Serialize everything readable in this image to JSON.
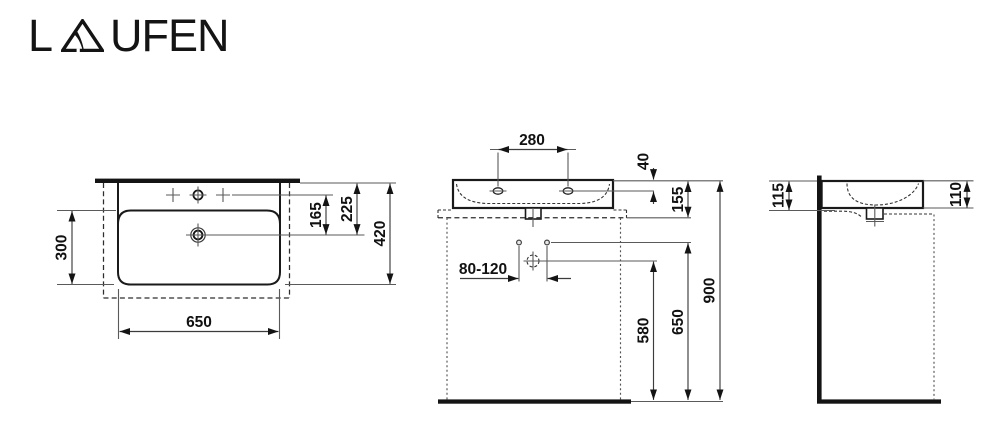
{
  "brand": {
    "name": "LAUFEN",
    "logo_l": "L",
    "logo_rest": "UFEN"
  },
  "drawing": {
    "views": {
      "plan": {
        "dims": {
          "bowl_depth": "300",
          "width": "650",
          "drain_to_taphole": "165",
          "drain_to_rear": "225",
          "depth_overall": "420"
        }
      },
      "front": {
        "dims": {
          "taphole_spacing": "280",
          "rim_to_taphole": "40",
          "rim_to_underside": "155",
          "drain_offset_range": "80-120",
          "drain_height": "580",
          "fixings_height": "650",
          "rim_height": "900"
        }
      },
      "side": {
        "dims": {
          "front_edge_height": "115",
          "basin_height": "110"
        }
      }
    }
  },
  "colors": {
    "line": "#1a1a1a",
    "thin_line": "#5a5a5a",
    "background": "#ffffff"
  }
}
